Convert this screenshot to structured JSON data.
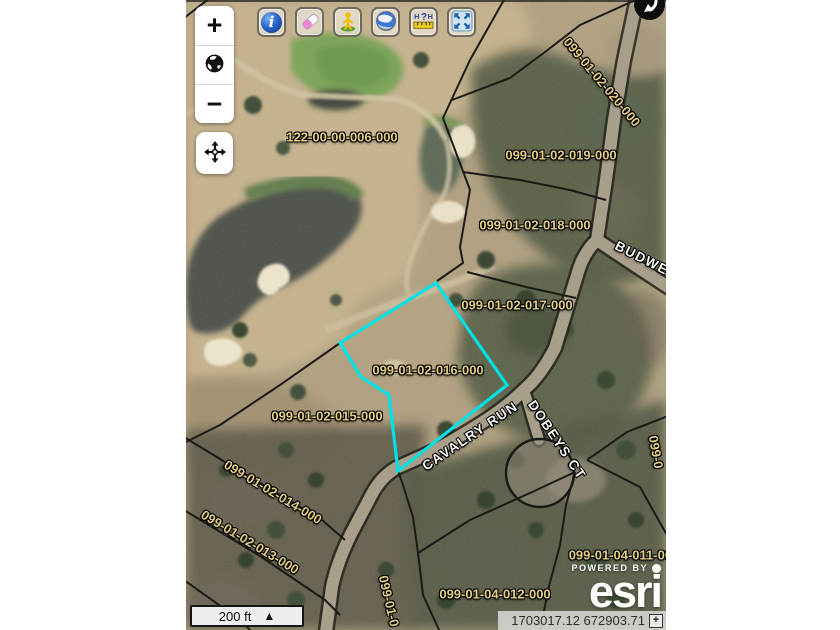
{
  "app": {
    "type": "parcel-map-viewer"
  },
  "selected_parcel": {
    "id": "099-01-02-016-000",
    "outline_color": "#00e1e6"
  },
  "map_labels": [
    {
      "text": "122-00-00-006-000",
      "kind": "parcel"
    },
    {
      "text": "099-01-02-020-000",
      "kind": "parcel"
    },
    {
      "text": "099-01-02-019-000",
      "kind": "parcel"
    },
    {
      "text": "099-01-02-018-000",
      "kind": "parcel"
    },
    {
      "text": "BUDWE",
      "kind": "road"
    },
    {
      "text": "099-01-02-017-000",
      "kind": "parcel"
    },
    {
      "text": "099-01-02-016-000",
      "kind": "parcel"
    },
    {
      "text": "099-01-02-015-000",
      "kind": "parcel"
    },
    {
      "text": "CAVALRY RUN",
      "kind": "road"
    },
    {
      "text": "DOBEYS CT",
      "kind": "road"
    },
    {
      "text": "099-01-02-014-000",
      "kind": "parcel"
    },
    {
      "text": "099-01-02-013-000",
      "kind": "parcel"
    },
    {
      "text": "099-01-0",
      "kind": "parcel"
    },
    {
      "text": "099-01-04-012-000",
      "kind": "parcel"
    },
    {
      "text": "099-01-04-011-000",
      "kind": "parcel"
    },
    {
      "text": "099-0",
      "kind": "parcel"
    }
  ],
  "map_controls": {
    "zoom_in": "+",
    "zoom_out": "−",
    "basemap_icon": "globe-icon",
    "pan_icon": "pan-crosshair-icon"
  },
  "toolbar": {
    "buttons": [
      {
        "name": "identify",
        "icon": "info-icon",
        "glyph": "i"
      },
      {
        "name": "erase",
        "icon": "eraser-icon"
      },
      {
        "name": "street-view",
        "icon": "pegman-icon"
      },
      {
        "name": "google-earth",
        "icon": "earth-globe-icon"
      },
      {
        "name": "measure",
        "icon": "measure-ruler-icon",
        "glyphs": {
          "left": "H",
          "mid": "?",
          "right": "H"
        }
      },
      {
        "name": "full-extent",
        "icon": "full-extent-icon"
      }
    ]
  },
  "overview": {
    "icon": "collapse-arrow-icon"
  },
  "scalebar": {
    "distance": "200 ft",
    "expander": "▲"
  },
  "statusbar": {
    "coordinates": "1703017.12 672903.71",
    "expander": "+"
  },
  "attribution": {
    "powered_by": "POWERED BY",
    "brand": "esri"
  }
}
